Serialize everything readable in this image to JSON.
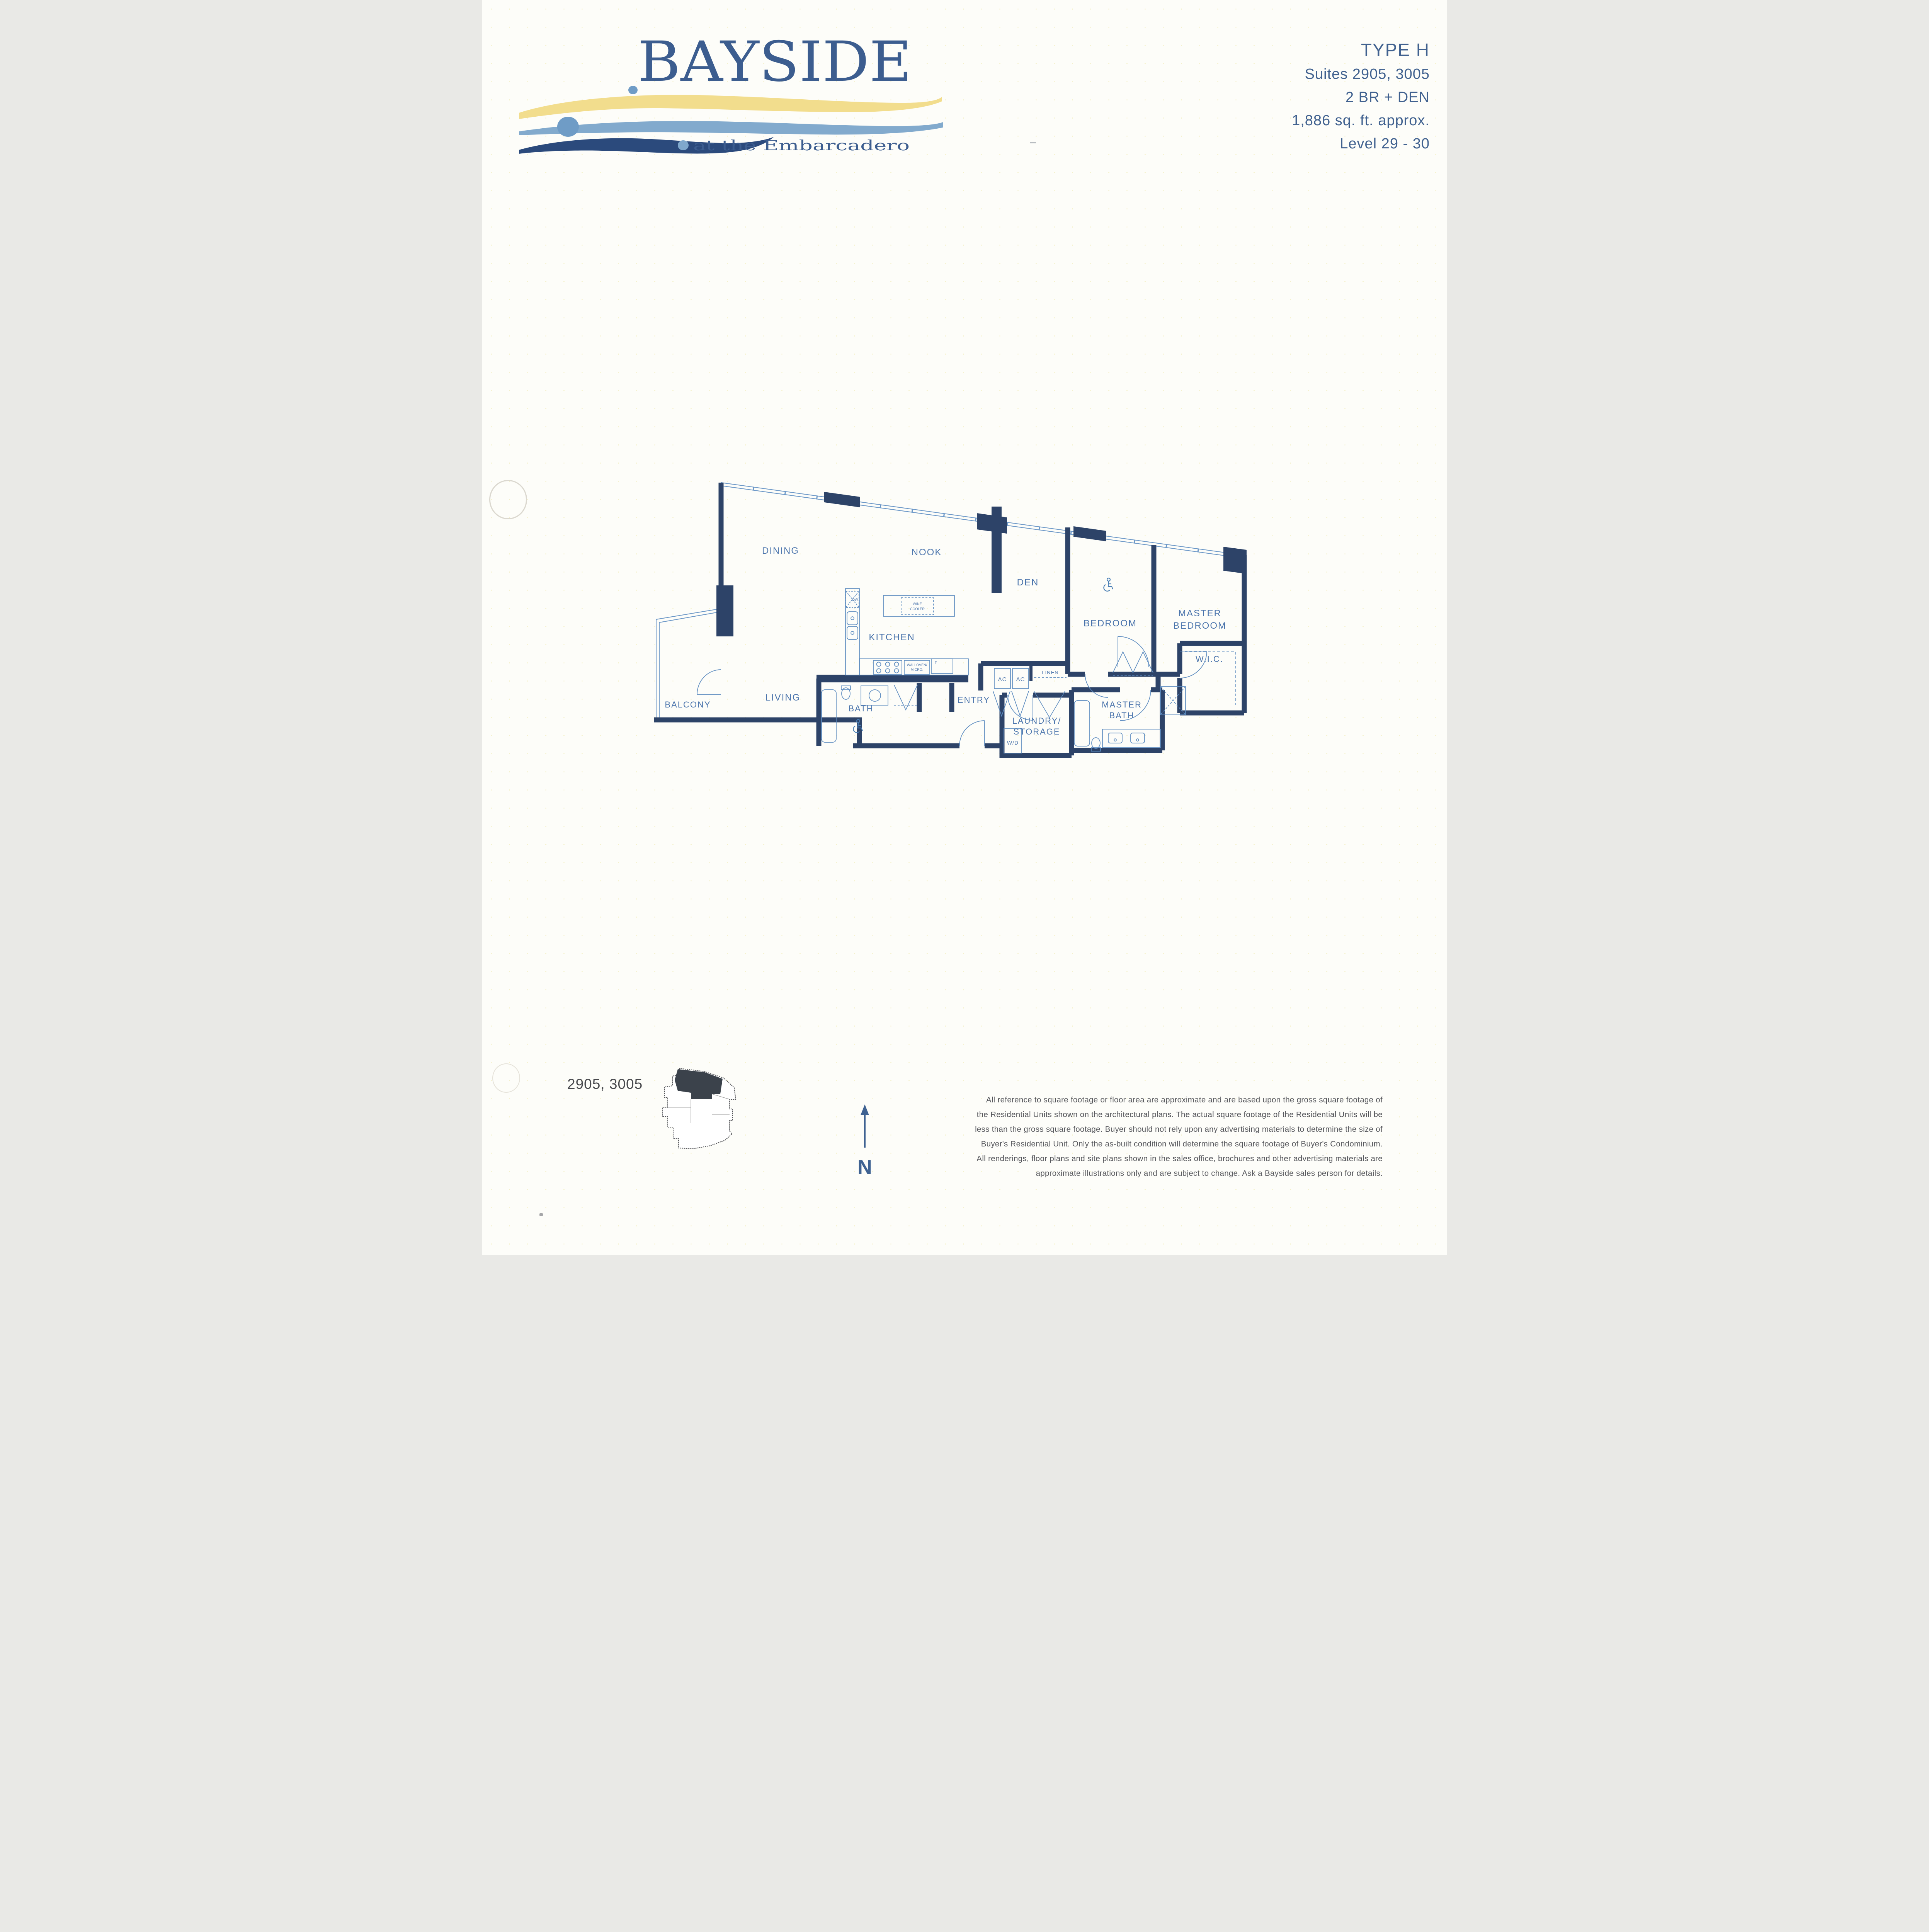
{
  "logo": {
    "wordmark": "BAYSIDE",
    "tagline": "at the Embarcadero"
  },
  "header": {
    "type": "TYPE H",
    "suites": "Suites 2905, 3005",
    "config": "2 BR + DEN",
    "area": "1,886 sq. ft. approx.",
    "level": "Level 29 - 30"
  },
  "floor_plan": {
    "rooms": {
      "dining": "DINING",
      "nook": "NOOK",
      "den": "DEN",
      "bedroom": "BEDROOM",
      "master_bedroom_line1": "MASTER",
      "master_bedroom_line2": "BEDROOM",
      "balcony": "BALCONY",
      "living": "LIVING",
      "kitchen": "KITCHEN",
      "bath": "BATH",
      "entry": "ENTRY",
      "laundry_line1": "LAUNDRY/",
      "laundry_line2": "STORAGE",
      "master_bath_line1": "MASTER",
      "master_bath_line2": "BATH",
      "wic": "W.I.C."
    },
    "closets": {
      "ac1": "AC",
      "ac2": "AC",
      "linen": "LINEN",
      "washer_dryer": "W/D"
    },
    "appliances": {
      "dishwasher": "DW",
      "wine_cooler_line1": "WINE",
      "wine_cooler_line2": "COOLER",
      "wall_oven_line1": "WALLOVEN/",
      "wall_oven_line2": "MICRO.",
      "fridge": "F"
    }
  },
  "key_plan": {
    "label": "2905, 3005"
  },
  "compass": {
    "north": "N"
  },
  "disclaimer": {
    "lines": [
      "All reference to square footage or floor area are approximate and are based upon the gross square footage of",
      "the Residential Units shown on the architectural plans.  The actual square footage of the Residential Units will be",
      "less than the gross square footage.  Buyer should not rely upon any advertising materials to determine the size of",
      "Buyer's Residential Unit.  Only the as-built condition will determine the square footage of Buyer's Condominium.",
      "All renderings, floor plans and site plans shown in the sales office, brochures and other advertising materials are",
      "approximate illustrations only and are subject to change.  Ask a Bayside sales person for details."
    ]
  },
  "colors": {
    "brand_blue": "#3c5d8f",
    "wall_navy": "#2d4368",
    "plan_line": "#5d8cc0",
    "wave_yellow": "#f2dd8d",
    "wave_blue": "#82aacd",
    "wave_navy": "#2b4a7c",
    "disclaimer_gray": "#54555a"
  }
}
